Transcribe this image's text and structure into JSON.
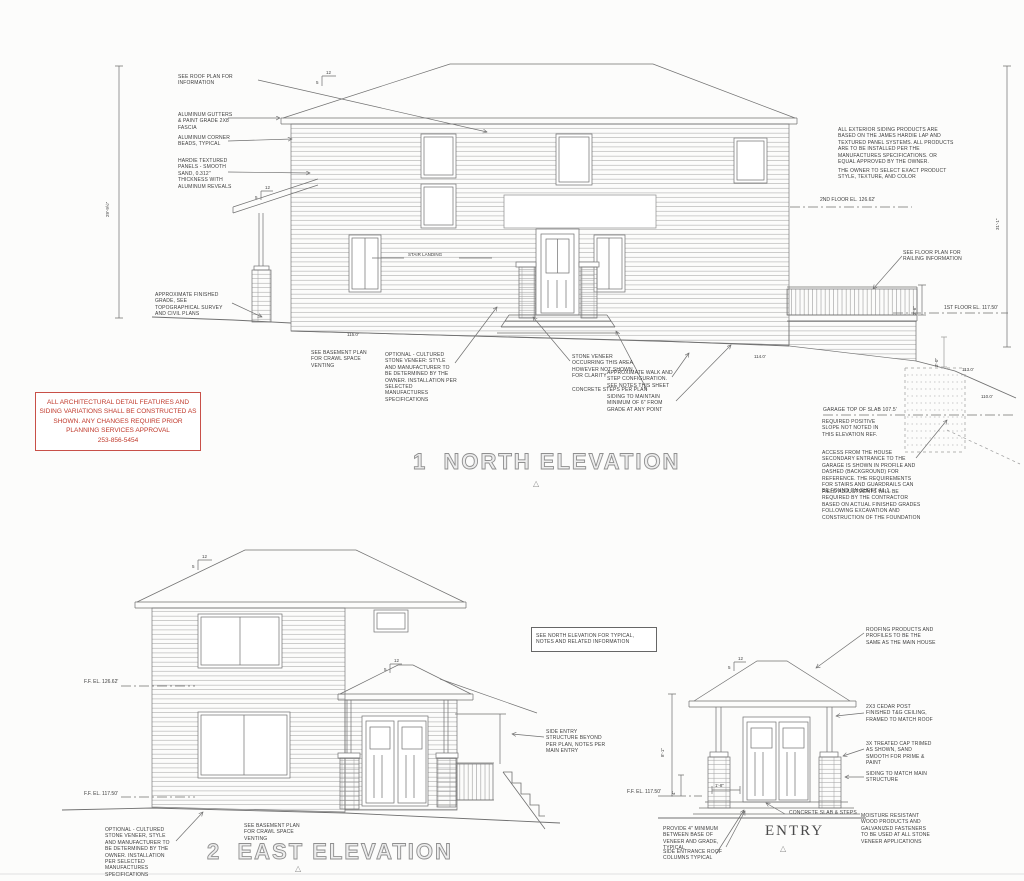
{
  "colors": {
    "stamp_red": "#c0392b",
    "line_gray": "#707070"
  },
  "icons": {
    "elevation_marker": "△"
  },
  "slope": {
    "rise": "5",
    "run": "12"
  },
  "stamp": {
    "text": "ALL ARCHITECTURAL DETAIL FEATURES AND SIDING VARIATIONS SHALL BE CONSTRUCTED AS SHOWN. ANY CHANGES REQUIRE PRIOR PLANNING SERVICES APPROVAL",
    "phone": "253-856-5454"
  },
  "north": {
    "number": "1",
    "title": "NORTH ELEVATION",
    "labels": {
      "stair_landing": "STAIR LANDING"
    },
    "notes": {
      "roof_plan": "SEE ROOF PLAN FOR INFORMATION",
      "gutters": "ALUMINUM GUTTERS & PAINT GRADE 2X8 FASCIA",
      "corner_beads": "ALUMINUM CORNER BEADS, TYPICAL",
      "hardie": "HARDIE TEXTURED PANELS - SMOOTH SAND, 0.312\" THICKNESS WITH ALUMINUM REVEALS",
      "finished_grade": "APPROXIMATE FINISHED GRADE, SEE TOPOGRAPHICAL SURVEY AND CIVIL PLANS",
      "basement_plan": "SEE  BASEMENT PLAN FOR CRAWL SPACE VENTING",
      "cultured_stone": "OPTIONAL - CULTURED STONE VENEER: STYLE AND MANUFACTURER TO BE DETERMINED BY THE OWNER.  INSTALLATION PER SELECTED MANUFACTURES SPECIFICATIONS",
      "stone_veneer": "STONE VENEER OCCURRING THIS AREA HOWEVER NOT SHOWN FOR CLARITY",
      "concrete_steps": "CONCRETE STEPS PER PLAN",
      "walk_step": "APPROXIMATE WALK AND STEP CONFIGURATION. SEE NOTES THIS SHEET",
      "siding_grade": "SIDING TO MAINTAIN MINIMUM OF 6\" FROM GRADE AT ANY POINT",
      "siding_products": "ALL EXTERIOR SIDING PRODUCTS ARE BASED ON THE JAMES HARDIE LAP AND TEXTURED PANEL SYSTEMS.  ALL PRODUCTS ARE TO BE INSTALLED PER THE MANUFACTURES SPECIFICATIONS.  OR EQUAL APPROVED BY THE OWNER.",
      "owner_select": "THE OWNER TO SELECT EXACT PRODUCT STYLE,  TEXTURE,  AND COLOR",
      "railing_info": "SEE FLOOR PLAN FOR RAILING INFORMATION",
      "garage_slab": "GARAGE TOP OF SLAB 107.5'",
      "positive_slope": "REQUIRED POSITIVE SLOPE NOT NOTED IN THIS ELEVATION REF.",
      "access": "ACCESS FROM THE HOUSE SECONDARY ENTRANCE TO THE GARAGE IS SHOWN IN PROFILE AND DASHED (BACKGROUND) FOR REFERENCE.  THE REQUIREMENTS FOR STAIRS AND GUARDRAILS CAN BE FOUND ON SHEET A1.1.",
      "field_adjust": "FIELD ADJUSTMENTS WILL BE REQUIRED BY THE CONTRACTOR BASED ON ACTUAL FINISHED GRADES FOLLOWING EXCAVATION AND CONSTRUCTION OF THE FOUNDATION"
    },
    "levels": {
      "second_floor": "2ND FLOOR EL. 126.62'",
      "first_floor": "1ST FLOOR EL. 117.50'"
    },
    "grades": {
      "g115": "115.0'",
      "g114": "114.0'",
      "g113": "113.0'",
      "g110": "110.0'"
    },
    "dims": {
      "left_height": "29'-9½\"",
      "right_height": "31'-1\"",
      "deck_rail": "3'-6\"",
      "garage": "3'-0\""
    }
  },
  "east": {
    "number": "2",
    "title": "EAST ELEVATION",
    "notes": {
      "north_ref": "SEE NORTH ELEVATION FOR TYPICAL, NOTES AND RELATED INFORMATION",
      "side_entry": "SIDE ENTRY STRUCTURE BEYOND PER PLAN, NOTES PER MAIN ENTRY",
      "basement_plan": "SEE  BASEMENT PLAN FOR CRAWL SPACE VENTING",
      "cultured_stone": "OPTIONAL - CULTURED STONE VENEER, STYLE AND MANUFACTURER TO BE DETERMINED BY THE OWNER.  INSTALLATION PER SELECTED MANUFACTURES SPECIFICATIONS"
    },
    "levels": {
      "ff_upper": "F.F. EL. 126.62'",
      "ff_lower": "F.F. EL. 117.50'"
    }
  },
  "entry": {
    "title": "ENTRY",
    "notes": {
      "roofing": "ROOFING PRODUCTS AND PROFILES TO BE THE SAME AS THE MAIN HOUSE",
      "cedar_post": "2X3 CEDAR POST  FINISHED T&G CEILING, FRAMED TO MATCH ROOF",
      "treated_cap": "3X TREATED CAP TRIMED AS SHOWN, SAND SMOOTH FOR PRIME & PAINT",
      "siding_match": "SIDING TO MATCH MAIN STRUCTURE",
      "moisture": "MOISTURE RESISTANT WOOD PRODUCTS  AND GALVANIZED FASTENERS TO BE USED AT ALL  STONE VENEER APPLICATIONS",
      "slab_steps": "CONCRETE SLAB & STEPS",
      "veneer_grade": "PROVIDE 4\" MINIMUM BETWEEN BASE OF VENEER AND GRADE, TYPICAL",
      "roof_columns": "SIDE ENTRANCE ROOF COLUMNS TYPICAL"
    },
    "levels": {
      "ff": "F.F. EL. 117.50'"
    },
    "dims": {
      "base": "1'-8\"",
      "height": "8'-1\"",
      "veneer_min": "4\""
    }
  }
}
